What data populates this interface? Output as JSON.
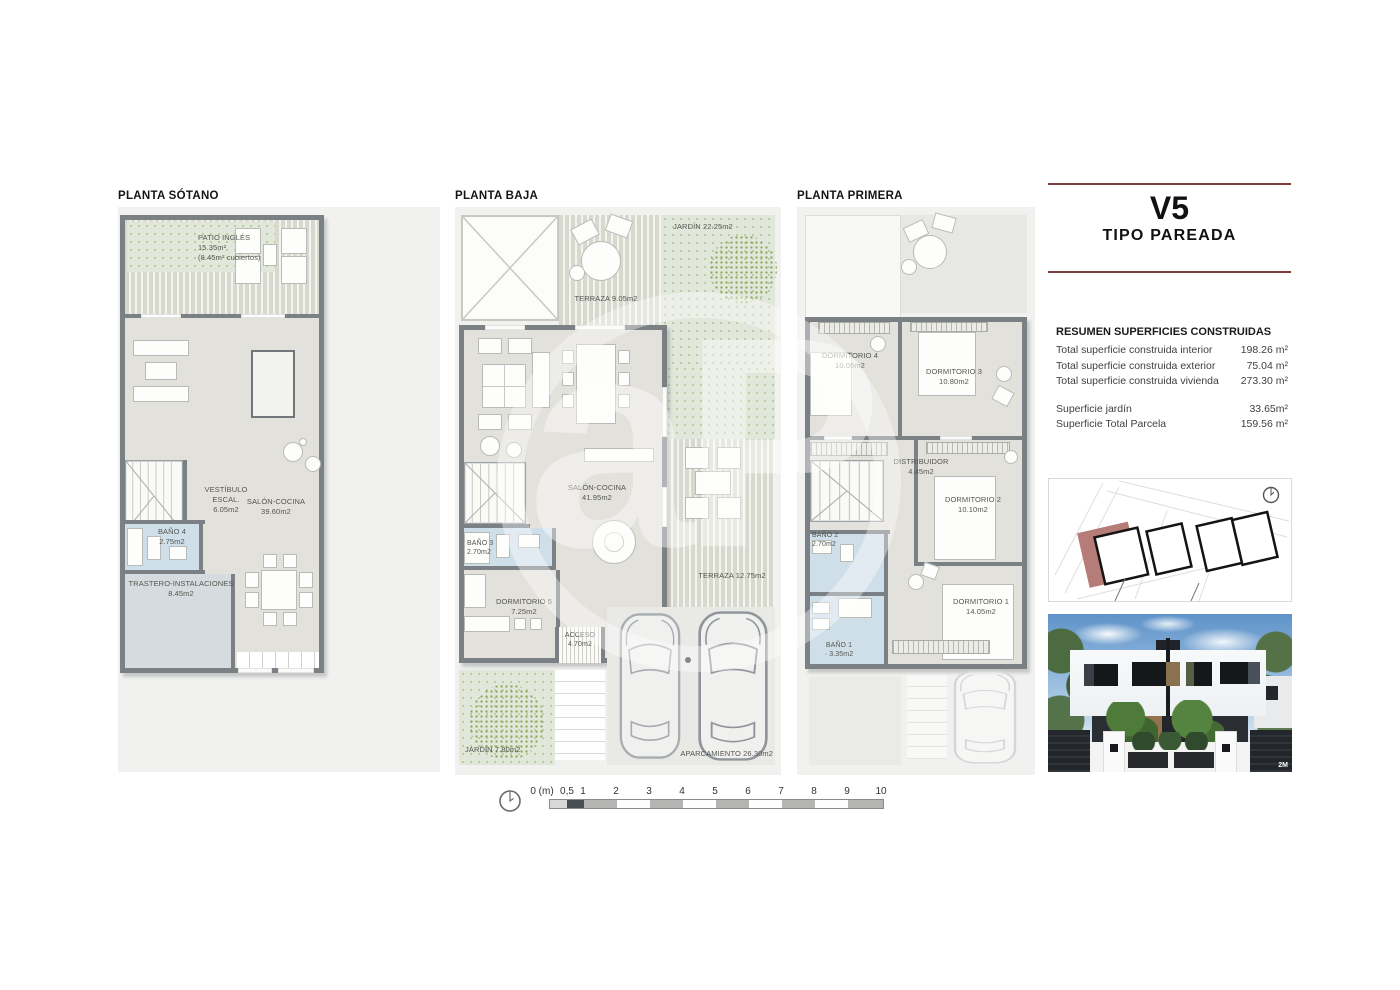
{
  "colors": {
    "accent_rule": "#7d3e3d",
    "site_highlight": "#b67c78",
    "wall": "#7b8084",
    "paper": "#f1f1ef",
    "wet_room": "#cfdfe9",
    "garden": "#e1e7db"
  },
  "watermark": {
    "text": "aP"
  },
  "plans": [
    {
      "title": "PLANTA SÓTANO",
      "labels": {
        "patio": "PATIO INGLÉS\n15.35m²\n(8.45m² cubiertos)",
        "vestibulo": "VESTÍBULO\nESCAL.\n6.05m2",
        "salon": "SALÓN-COCINA\n39.60m2",
        "bano4": "BAÑO 4\n2.75m2",
        "trastero": "TRASTERO-INSTALACIONES\n8.45m2"
      }
    },
    {
      "title": "PLANTA BAJA",
      "labels": {
        "jardin_top": "JARDÍN 22.25m2",
        "terraza_top": "TERRAZA 9.05m2",
        "salon": "SALÓN-COCINA\n41.95m2",
        "bano3": "BAÑO 3\n2.70m2",
        "dorm5": "DORMITORIO 5\n7.25m2",
        "terraza_right": "TERRAZA 12.75m2",
        "acceso": "ACCESO\n4.70m2",
        "jardin_bottom": "JARDÍN 7.80m2",
        "aparcamiento": "APARCAMIENTO 26.30m2"
      }
    },
    {
      "title": "PLANTA PRIMERA",
      "labels": {
        "dorm4": "DORMITORIO 4\n10.05m2",
        "dorm3": "DORMITORIO 3\n10.80m2",
        "distribuidor": "DISTRIBUIDOR\n4.45m2",
        "dorm2": "DORMITORIO 2\n10.10m2",
        "bano2": "BAÑO 2\n2.70m2",
        "bano1": "BAÑO 1\n· 3.35m2",
        "dorm1": "DORMITORIO 1\n14.05m2"
      }
    }
  ],
  "scalebar": {
    "labels": [
      "0 (m)",
      "0,5",
      "1",
      "2",
      "3",
      "4",
      "5",
      "6",
      "7",
      "8",
      "9",
      "10"
    ]
  },
  "panel": {
    "title": "V5",
    "subtitle": "TIPO PAREADA",
    "summary_heading": "RESUMEN SUPERFICIES CONSTRUIDAS",
    "summary_rows": [
      {
        "label": "Total superficie construida interior",
        "value": "198.26 m²"
      },
      {
        "label": "Total superficie construida exterior",
        "value": "75.04 m²"
      },
      {
        "label": "Total superficie construida vivienda",
        "value": "273.30 m²"
      }
    ],
    "summary_rows2": [
      {
        "label": "Superficie jardín",
        "value": "33.65m²"
      },
      {
        "label": "Superficie Total Parcela",
        "value": "159.56 m²"
      }
    ],
    "render_credit": "2M"
  }
}
